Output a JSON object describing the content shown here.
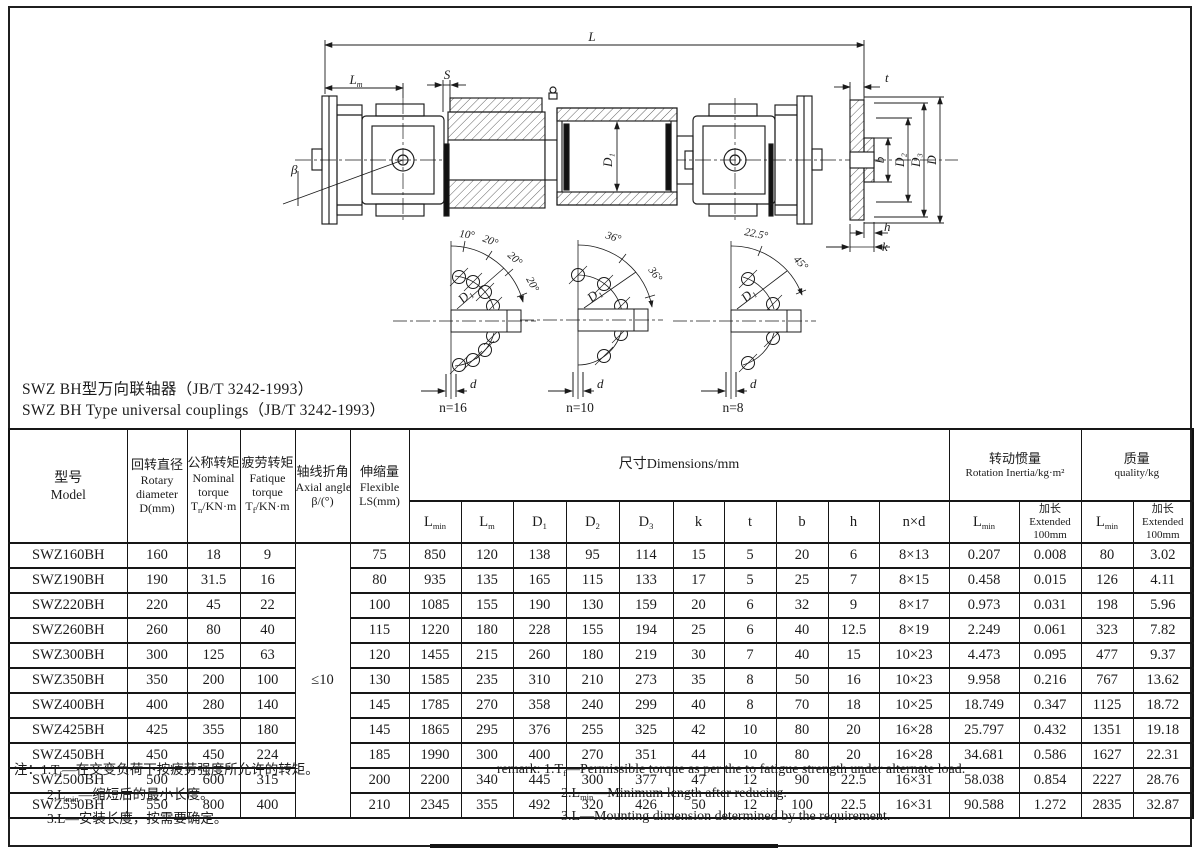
{
  "titles": {
    "cn": "SWZ BH型万向联轴器（JB/T 3242-1993）",
    "en": "SWZ BH Type universal couplings（JB/T 3242-1993）"
  },
  "drawing": {
    "labels": {
      "L": "L",
      "Lm_base": "L",
      "Lm_sub": "m",
      "S": "S",
      "t": "t",
      "beta": "β",
      "tube_dia": "D₁",
      "b": "b",
      "D2": "D₂",
      "D3": "D₃",
      "D": "D",
      "h": "h",
      "k": "k"
    },
    "diagrams": [
      {
        "n": "n=16",
        "angles": [
          "10°",
          "20°",
          "20°",
          "20°"
        ],
        "circle_label": "D₁",
        "hole_label": "d"
      },
      {
        "n": "n=10",
        "angles": [
          "36°",
          "36°"
        ],
        "circle_label": "D₁",
        "hole_label": "d"
      },
      {
        "n": "n=8",
        "angles": [
          "22.5°",
          "45°"
        ],
        "circle_label": "D₁",
        "hole_label": "d"
      }
    ]
  },
  "table": {
    "header": {
      "model_cn": "型号",
      "model_en": "Model",
      "rotary": [
        "回转直径",
        "Rotary",
        "diameter",
        "D(mm)"
      ],
      "nominal": [
        "公称转矩",
        "Nominal",
        "torque"
      ],
      "nominal_sym": {
        "base": "T",
        "sub": "n",
        "rest": "/KN·m"
      },
      "fatique": [
        "疲劳转矩",
        "Fatique",
        "torque"
      ],
      "fatique_sym": {
        "base": "T",
        "sub": "f",
        "rest": "/KN·m"
      },
      "axial": [
        "轴线折角",
        "Axial angle",
        "β/(°)"
      ],
      "flex": [
        "伸缩量",
        "Flexible",
        "LS(mm)"
      ],
      "dims_title": "尺寸Dimensions/mm",
      "dim_cols": [
        {
          "b": "L",
          "s": "min"
        },
        {
          "b": "L",
          "s": "m"
        },
        {
          "b": "D",
          "s": "1"
        },
        {
          "b": "D",
          "s": "2"
        },
        {
          "b": "D",
          "s": "3"
        },
        {
          "b": "k"
        },
        {
          "b": "t"
        },
        {
          "b": "b"
        },
        {
          "b": "h"
        },
        {
          "b": "n×d"
        }
      ],
      "inertia_cn": "转动惯量",
      "inertia_en": "Rotation Inertia/kg·m²",
      "quality_cn": "质量",
      "quality_en": "quality/kg",
      "lmin": {
        "b": "L",
        "s": "min"
      },
      "ext": [
        "加长",
        "Extended",
        "100mm"
      ]
    },
    "beta_value": "≤10",
    "rows": [
      [
        "SWZ160BH",
        "160",
        "18",
        "9",
        "75",
        "850",
        "120",
        "138",
        "95",
        "114",
        "15",
        "5",
        "20",
        "6",
        "8×13",
        "0.207",
        "0.008",
        "80",
        "3.02"
      ],
      [
        "SWZ190BH",
        "190",
        "31.5",
        "16",
        "80",
        "935",
        "135",
        "165",
        "115",
        "133",
        "17",
        "5",
        "25",
        "7",
        "8×15",
        "0.458",
        "0.015",
        "126",
        "4.11"
      ],
      [
        "SWZ220BH",
        "220",
        "45",
        "22",
        "100",
        "1085",
        "155",
        "190",
        "130",
        "159",
        "20",
        "6",
        "32",
        "9",
        "8×17",
        "0.973",
        "0.031",
        "198",
        "5.96"
      ],
      [
        "SWZ260BH",
        "260",
        "80",
        "40",
        "115",
        "1220",
        "180",
        "228",
        "155",
        "194",
        "25",
        "6",
        "40",
        "12.5",
        "8×19",
        "2.249",
        "0.061",
        "323",
        "7.82"
      ],
      [
        "SWZ300BH",
        "300",
        "125",
        "63",
        "120",
        "1455",
        "215",
        "260",
        "180",
        "219",
        "30",
        "7",
        "40",
        "15",
        "10×23",
        "4.473",
        "0.095",
        "477",
        "9.37"
      ],
      [
        "SWZ350BH",
        "350",
        "200",
        "100",
        "130",
        "1585",
        "235",
        "310",
        "210",
        "273",
        "35",
        "8",
        "50",
        "16",
        "10×23",
        "9.958",
        "0.216",
        "767",
        "13.62"
      ],
      [
        "SWZ400BH",
        "400",
        "280",
        "140",
        "145",
        "1785",
        "270",
        "358",
        "240",
        "299",
        "40",
        "8",
        "70",
        "18",
        "10×25",
        "18.749",
        "0.347",
        "1125",
        "18.72"
      ],
      [
        "SWZ425BH",
        "425",
        "355",
        "180",
        "145",
        "1865",
        "295",
        "376",
        "255",
        "325",
        "42",
        "10",
        "80",
        "20",
        "16×28",
        "25.797",
        "0.432",
        "1351",
        "19.18"
      ],
      [
        "SWZ450BH",
        "450",
        "450",
        "224",
        "185",
        "1990",
        "300",
        "400",
        "270",
        "351",
        "44",
        "10",
        "80",
        "20",
        "16×28",
        "34.681",
        "0.586",
        "1627",
        "22.31"
      ],
      [
        "SWZ500BH",
        "500",
        "600",
        "315",
        "200",
        "2200",
        "340",
        "445",
        "300",
        "377",
        "47",
        "12",
        "90",
        "22.5",
        "16×31",
        "58.038",
        "0.854",
        "2227",
        "28.76"
      ],
      [
        "SWZ550BH",
        "550",
        "800",
        "400",
        "210",
        "2345",
        "355",
        "492",
        "320",
        "426",
        "50",
        "12",
        "100",
        "22.5",
        "16×31",
        "90.588",
        "1.272",
        "2835",
        "32.87"
      ]
    ]
  },
  "notes_cn": {
    "l1_pre": "注：1.T",
    "l1_sub": "f",
    "l1_post": "—在交变负荷下按疲劳强度所允许的转矩。",
    "l2_pre": "2.L",
    "l2_sub": "min",
    "l2_post": "—缩短后的最小长度。",
    "l3": "3.L—安装长度，按需要确定。"
  },
  "notes_en": {
    "l1_pre": "remark: 1.T",
    "l1_sub": "f",
    "l1_post": "—Permissible torque as per the to fatigue strength under alternate load.",
    "l2_pre": "2.L",
    "l2_sub": "min",
    "l2_post": "—Minimum length after reducing.",
    "l3": "3.L—Mounting dimension determined by the requirement."
  }
}
